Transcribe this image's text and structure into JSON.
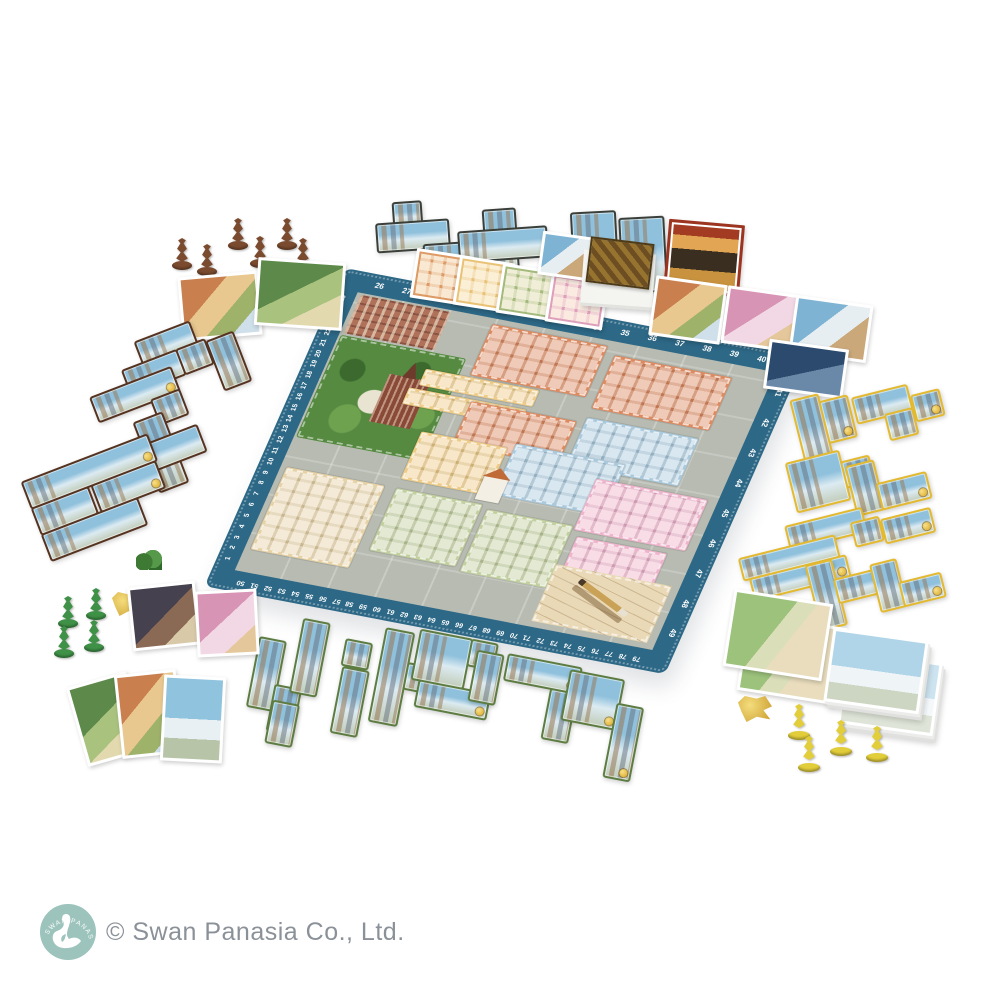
{
  "scene": {
    "type": "board game product photo",
    "background_color": "#ffffff"
  },
  "board": {
    "border_color": "#2d6886",
    "street_color": "#b7bbb1",
    "track": {
      "number_color": "#ffffff",
      "top": [
        26,
        27,
        28,
        29,
        30,
        31,
        32,
        33,
        34,
        35,
        36,
        37,
        38,
        39,
        40
      ],
      "right": [
        41,
        42,
        43,
        44,
        45,
        46,
        47,
        48,
        49
      ],
      "bottom": [
        50,
        51,
        52,
        53,
        54,
        55,
        56,
        57,
        58,
        59,
        60,
        61,
        62,
        63,
        64,
        65,
        66,
        67,
        68,
        69,
        70,
        71,
        72,
        73,
        74,
        75,
        76,
        77,
        78,
        79
      ],
      "left": [
        1,
        2,
        3,
        4,
        5,
        6,
        7,
        8,
        9,
        10,
        11,
        12,
        13,
        14,
        15,
        16,
        17,
        18,
        19,
        20,
        21,
        22,
        23,
        24,
        25
      ]
    },
    "districts": [
      {
        "name": "park",
        "color": "#568a41"
      },
      {
        "name": "orange-district",
        "color": "#dd8a60"
      },
      {
        "name": "blue-district",
        "color": "#a9c9dd"
      },
      {
        "name": "pink-district",
        "color": "#efb3cb"
      },
      {
        "name": "yellow-district",
        "color": "#eecb86"
      },
      {
        "name": "tan-district",
        "color": "#e7d2a6"
      },
      {
        "name": "green-district",
        "color": "#c2cf9e"
      },
      {
        "name": "blueprint-corner",
        "color": "#ead9b6"
      }
    ],
    "landmarks": [
      "cathedral",
      "central-church",
      "brick-buildings"
    ]
  },
  "pieces": {
    "brown_meeples": {
      "count": 6,
      "color": "#7b4b2f"
    },
    "green_meeples": {
      "count": 4,
      "color": "#3f9147"
    },
    "yellow_meeples": {
      "count": 4,
      "color": "#e2cd3a"
    },
    "gold_token_left": {
      "color": "#d8a827"
    },
    "gold_token_right": {
      "color": "#e2c22f"
    },
    "brown_token": {
      "color": "#6e4526"
    }
  },
  "tiles": {
    "top_dark_tiles": {
      "border_color": "#3a3f3a",
      "groups": 3
    },
    "left_brown_tiles": {
      "border_color": "#553320",
      "groups": 5
    },
    "right_yellow_tiles": {
      "border_color": "#e3b92f",
      "groups": 9
    },
    "bottom_green_tiles": {
      "border_color": "#5d7c42",
      "groups": 9
    }
  },
  "cards": {
    "district_card_row_colors": [
      "#dd9a64",
      "#e9c276",
      "#a4ba7c",
      "#de9fba"
    ],
    "red_bonus_card_border": "#9c3420",
    "deck_box_color": "#f4f4f1",
    "fanned_card_count": 3
  },
  "footer": {
    "copyright": "© Swan Panasia Co., Ltd.",
    "text_color": "#8b9198",
    "logo": {
      "text": "SWAN PANASIA",
      "bg_color": "#9cc3bc",
      "swan_color": "#ffffff"
    }
  }
}
